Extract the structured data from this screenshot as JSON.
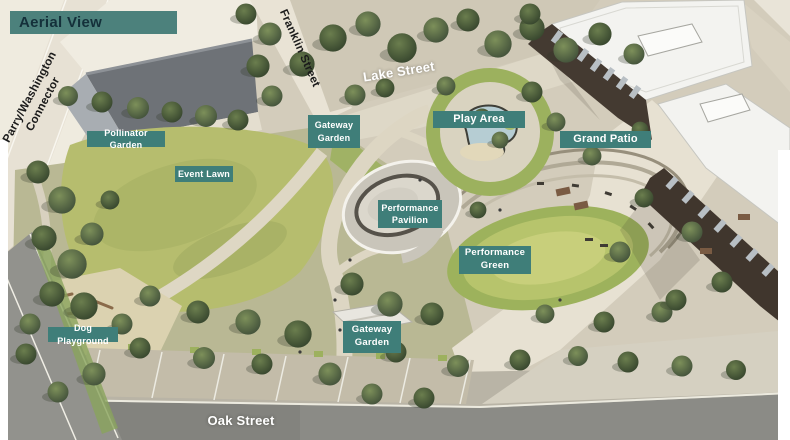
{
  "banner": {
    "label": "Aerial View"
  },
  "streets": {
    "parry": "Parry/Washington\nConnector",
    "franklin": "Franklin Street",
    "lake": "Lake Street",
    "oak": "Oak Street"
  },
  "areas": {
    "pollinator": "Pollinator Garden",
    "event_lawn": "Event Lawn",
    "gateway_top": "Gateway\nGarden",
    "play_area": "Play Area",
    "grand_patio": "Grand Patio",
    "pavilion": "Performance\nPavilion",
    "perf_green": "Performance\nGreen",
    "dog": "Dog Playground",
    "gateway_bottom": "Gateway\nGarden"
  },
  "colors": {
    "label_background": "#3f7e79",
    "label_text": "#ffffff",
    "banner_background": "#4c817c",
    "banner_text": "#14303a",
    "street_text_dark": "#1b1b1b",
    "street_text_light": "#ffffff",
    "lawn_green": "#b6bd6e",
    "performance_green": "#a9bd62",
    "road_gray": "#8b8b86",
    "roof_white": "#f3f3f0",
    "building_facade": "#41372d",
    "pond_water": "#b6cdd3",
    "ground_beige": "#d9d2c2"
  }
}
